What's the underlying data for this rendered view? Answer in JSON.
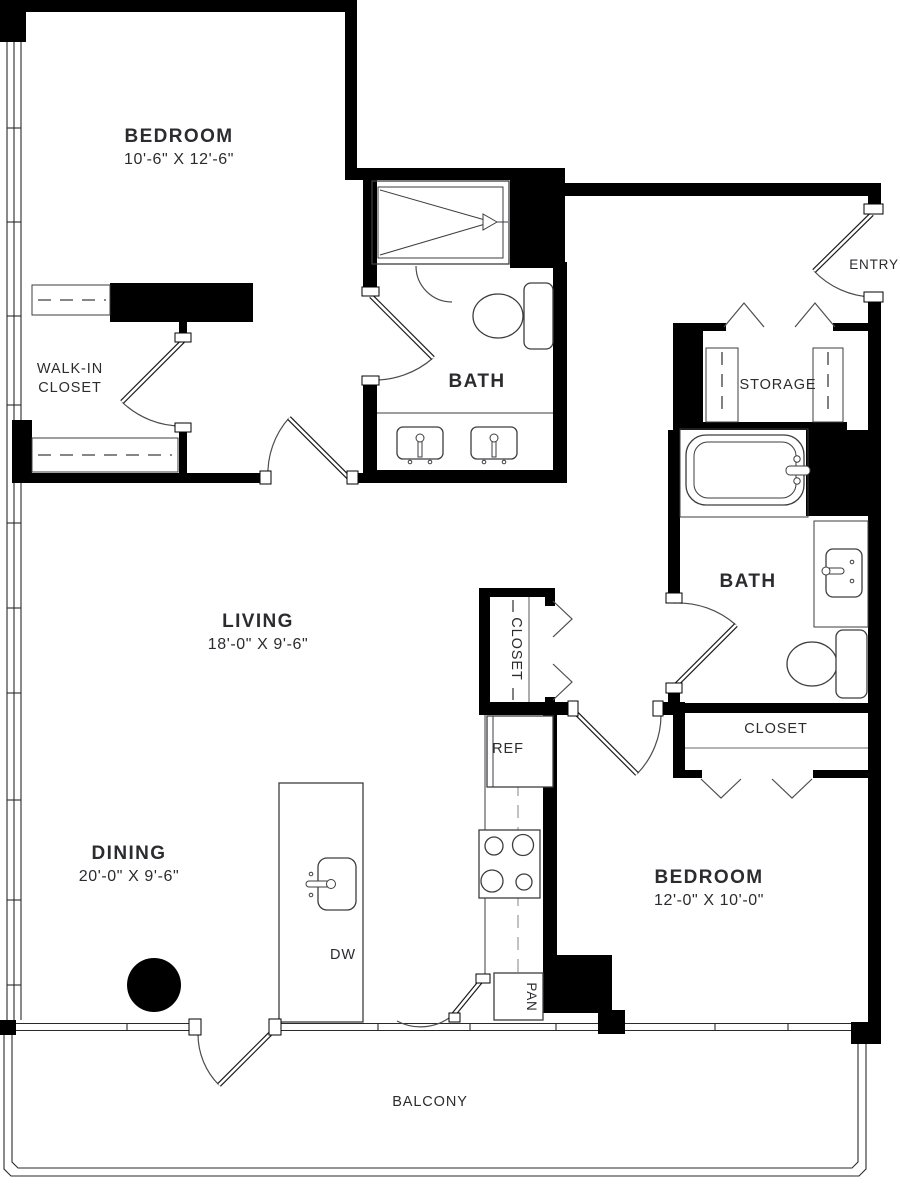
{
  "plan": {
    "rooms": {
      "bedroom1": {
        "name": "BEDROOM",
        "dims": "10'-6\" X 12'-6\""
      },
      "living": {
        "name": "LIVING",
        "dims": "18'-0\" X 9'-6\""
      },
      "dining": {
        "name": "DINING",
        "dims": "20'-0\" X 9'-6\""
      },
      "bedroom2": {
        "name": "BEDROOM",
        "dims": "12'-0\" X 10'-0\""
      },
      "bath1": {
        "name": "BATH"
      },
      "bath2": {
        "name": "BATH"
      },
      "walk_in_closet": {
        "line1": "WALK-IN",
        "line2": "CLOSET"
      },
      "hall_closet": {
        "name": "CLOSET"
      },
      "bedroom2_closet": {
        "name": "CLOSET"
      },
      "storage": {
        "name": "STORAGE"
      },
      "entry": {
        "name": "ENTRY"
      },
      "balcony": {
        "name": "BALCONY"
      }
    },
    "appliances": {
      "refrigerator": "REF",
      "dishwasher": "DW",
      "pantry": "PAN"
    },
    "colors": {
      "wall": "#000000",
      "fixture_line": "#3d3d40",
      "text": "#2c2c30",
      "background": "#ffffff"
    }
  }
}
